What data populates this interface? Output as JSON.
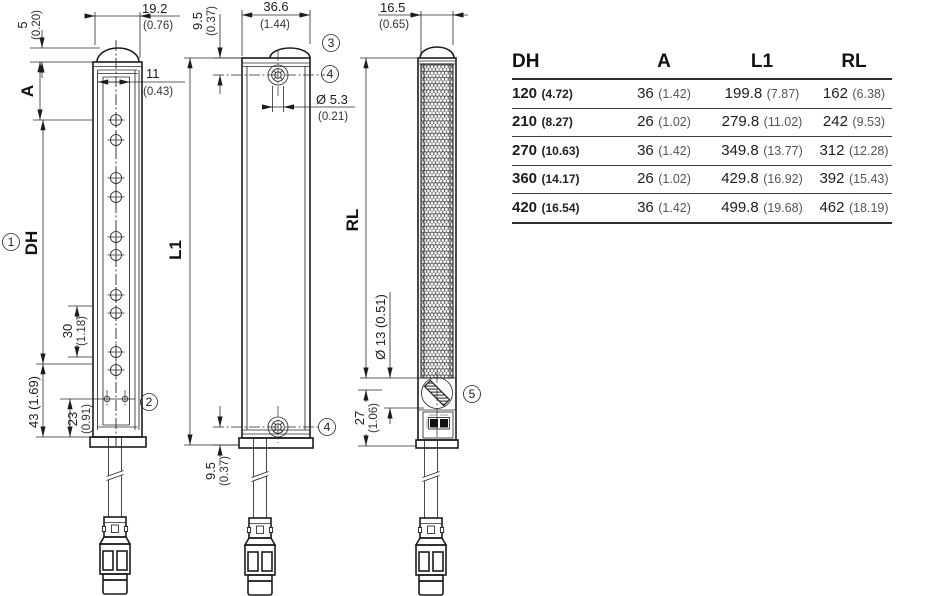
{
  "colors": {
    "line": "#1c1c1c",
    "text": "#1d1d1d",
    "muted": "#555",
    "rule": "#3f3f3f"
  },
  "labels": {
    "a": "A",
    "dh": "DH",
    "l1": "L1",
    "rl": "RL"
  },
  "callouts": {
    "c1": "1",
    "c2": "2",
    "c3": "3",
    "c4": "4",
    "c5": "5"
  },
  "dims": {
    "h5": {
      "v": "5",
      "alt": "(0.20)"
    },
    "w19_2": {
      "v": "19.2",
      "alt": "(0.76)"
    },
    "w11": {
      "v": "11",
      "alt": "(0.43)"
    },
    "p30": {
      "v": "30",
      "alt": "(1.18)"
    },
    "h43": {
      "v": "43 (1.69)"
    },
    "h23": {
      "v": "23",
      "alt": "(0.91)"
    },
    "h9_5_top": {
      "v": "9.5",
      "alt": "(0.37)"
    },
    "w36_6": {
      "v": "36.6",
      "alt": "(1.44)"
    },
    "d5_3": {
      "v": "Ø 5.3",
      "alt": "(0.21)"
    },
    "h9_5_bot": {
      "v": "9.5",
      "alt": "(0.37)"
    },
    "w16_5": {
      "v": "16.5",
      "alt": "(0.65)"
    },
    "d13": {
      "v": "Ø 13 (0.51)"
    },
    "h27": {
      "v": "27",
      "alt": "(1.06)"
    }
  },
  "table": {
    "headers": [
      "DH",
      "A",
      "L1",
      "RL"
    ],
    "rows": [
      {
        "dh": "120",
        "dh_alt": "(4.72)",
        "a": "36",
        "a_alt": "(1.42)",
        "l1": "199.8",
        "l1_alt": "(7.87)",
        "rl": "162",
        "rl_alt": "(6.38)"
      },
      {
        "dh": "210",
        "dh_alt": "(8.27)",
        "a": "26",
        "a_alt": "(1.02)",
        "l1": "279.8",
        "l1_alt": "(11.02)",
        "rl": "242",
        "rl_alt": "(9.53)"
      },
      {
        "dh": "270",
        "dh_alt": "(10.63)",
        "a": "36",
        "a_alt": "(1.42)",
        "l1": "349.8",
        "l1_alt": "(13.77)",
        "rl": "312",
        "rl_alt": "(12.28)"
      },
      {
        "dh": "360",
        "dh_alt": "(14.17)",
        "a": "26",
        "a_alt": "(1.02)",
        "l1": "429.8",
        "l1_alt": "(16.92)",
        "rl": "392",
        "rl_alt": "(15.43)"
      },
      {
        "dh": "420",
        "dh_alt": "(16.54)",
        "a": "36",
        "a_alt": "(1.42)",
        "l1": "499.8",
        "l1_alt": "(19.68)",
        "rl": "462",
        "rl_alt": "(18.19)"
      }
    ]
  }
}
